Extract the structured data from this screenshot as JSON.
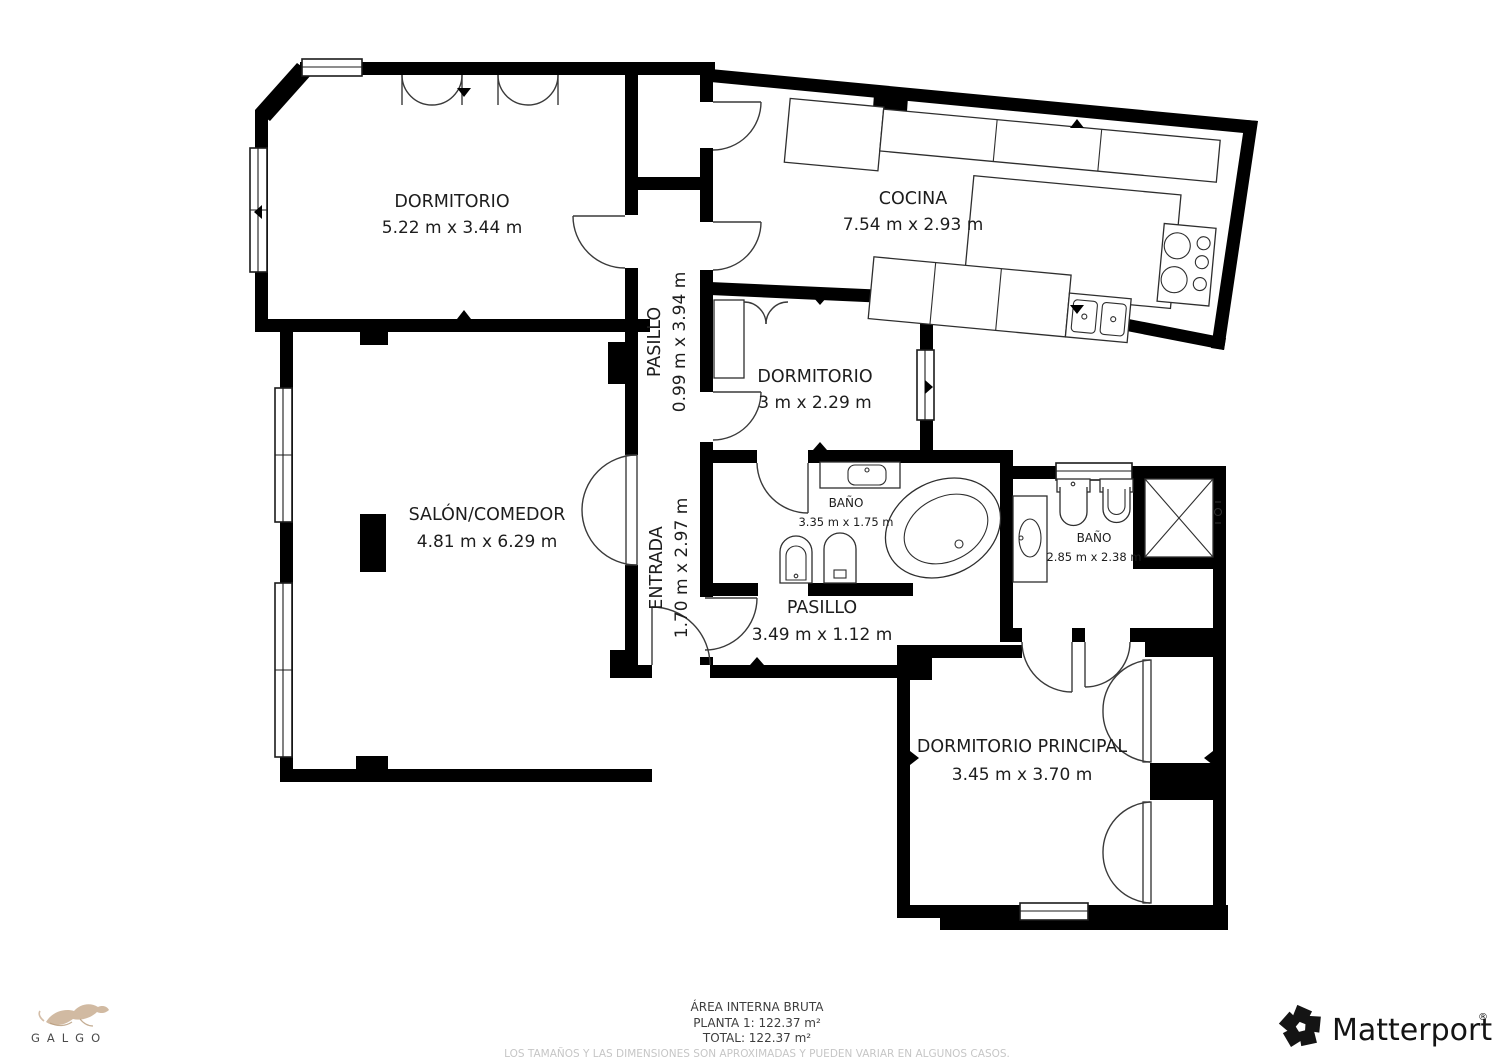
{
  "rooms": {
    "dormitorio": {
      "name": "DORMITORIO",
      "dims": "5.22 m x 3.44 m"
    },
    "cocina": {
      "name": "COCINA",
      "dims": "7.54 m x 2.93 m"
    },
    "pasillo_norte": {
      "name": "PASILLO",
      "dims": "0.99 m x 3.94 m"
    },
    "dormitorio_centro": {
      "name": "DORMITORIO",
      "dims": "3 m x 2.29 m"
    },
    "salon": {
      "name": "SALÓN/COMEDOR",
      "dims": "4.81 m x 6.29 m"
    },
    "entrada": {
      "name": "ENTRADA",
      "dims": "1.70 m x 2.97 m"
    },
    "bano_centro": {
      "name": "BAÑO",
      "dims": "3.35 m x 1.75 m"
    },
    "bano_este": {
      "name": "BAÑO",
      "dims": "2.85 m x 2.38 m"
    },
    "pasillo_sur": {
      "name": "PASILLO",
      "dims": "3.49 m x 1.12 m"
    },
    "dormitorio_principal": {
      "name": "DORMITORIO PRINCIPAL",
      "dims": "3.45 m x 3.70 m"
    }
  },
  "footer": {
    "area_title": "ÁREA INTERNA BRUTA",
    "planta_line": "PLANTA 1: 122.37 m²",
    "total_line": "TOTAL: 122.37 m²",
    "disclaimer": "LOS TAMAÑOS Y LAS DIMENSIONES SON APROXIMADAS Y PUEDEN VARIAR EN ALGUNOS CASOS."
  },
  "logos": {
    "galgo_text": "GALGO",
    "matterport_text": "Matterport",
    "matterport_reg": "®"
  },
  "colors": {
    "walls": "#000000",
    "paper": "#ffffff",
    "galgo_tan": "#c9ae92",
    "muted_text": "#c6c6c6"
  }
}
